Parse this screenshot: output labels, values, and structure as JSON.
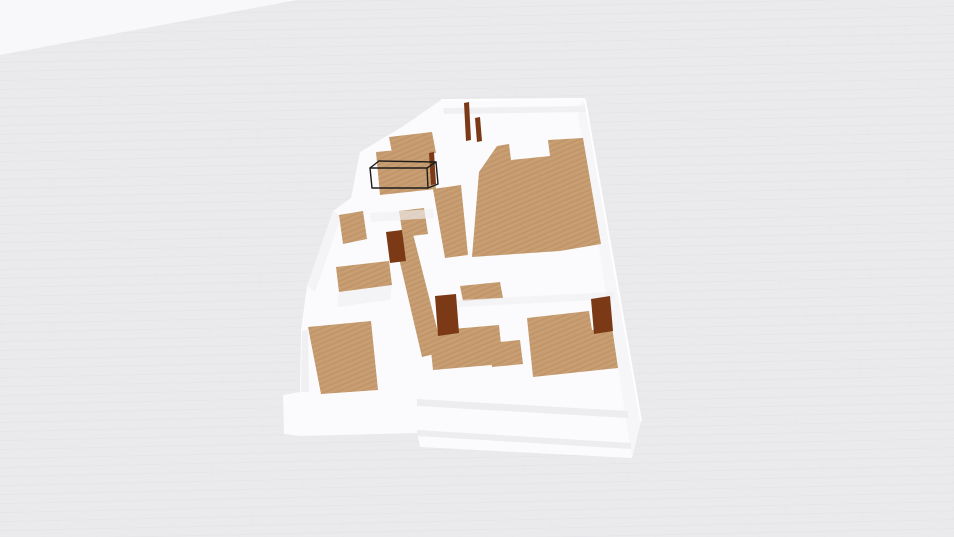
{
  "viewport": {
    "kind": "3d-floorplan-render",
    "view": "perspective-orbit",
    "visible_text": "",
    "selection": {
      "object": "wall-segment",
      "style": "black-wireframe-box"
    },
    "model": {
      "wall_material": "white",
      "floor_material": "wood-plank",
      "door_material": "dark-brown-wood",
      "wood_floor_regions": 12,
      "open_doors": 3,
      "door_edge_slivers": 3
    }
  },
  "colors": {
    "background": "#eaeaec",
    "ground_line": "#e0e0e4",
    "sky": "#f8f8fa",
    "wall": "#fbfbfd",
    "wall_bright": "#f6f6f8",
    "wall_shade": "#f0f0f3",
    "groove": "#ededf0",
    "floor_wood": "#c59b6f",
    "floor_wood_dark": "#b3875c",
    "floor_wood_light": "#d4ad82",
    "door": "#7b3916",
    "selection_outline": "#1d1d1d"
  }
}
